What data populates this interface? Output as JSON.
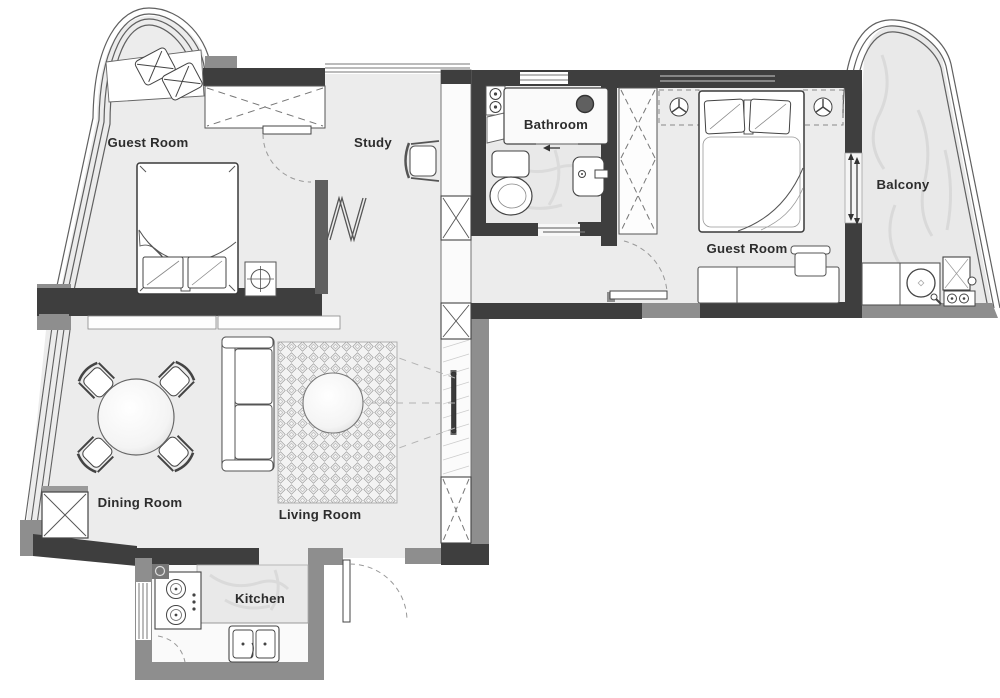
{
  "plan": {
    "rooms": [
      {
        "key": "guest_room_left",
        "label": "Guest Room"
      },
      {
        "key": "study",
        "label": "Study"
      },
      {
        "key": "bathroom",
        "label": "Bathroom"
      },
      {
        "key": "guest_room_right",
        "label": "Guest Room"
      },
      {
        "key": "balcony",
        "label": "Balcony"
      },
      {
        "key": "dining_room",
        "label": "Dining Room"
      },
      {
        "key": "living_room",
        "label": "Living Room"
      },
      {
        "key": "kitchen",
        "label": "Kitchen"
      }
    ],
    "colors": {
      "wall_dark": "#3e3e3e",
      "wall_medium": "#8e8e8e",
      "floor": "#ececec",
      "marble": "#e9e9e9",
      "glass_line": "#606060",
      "label_text": "#2d2d2d",
      "background": "#ffffff"
    }
  }
}
